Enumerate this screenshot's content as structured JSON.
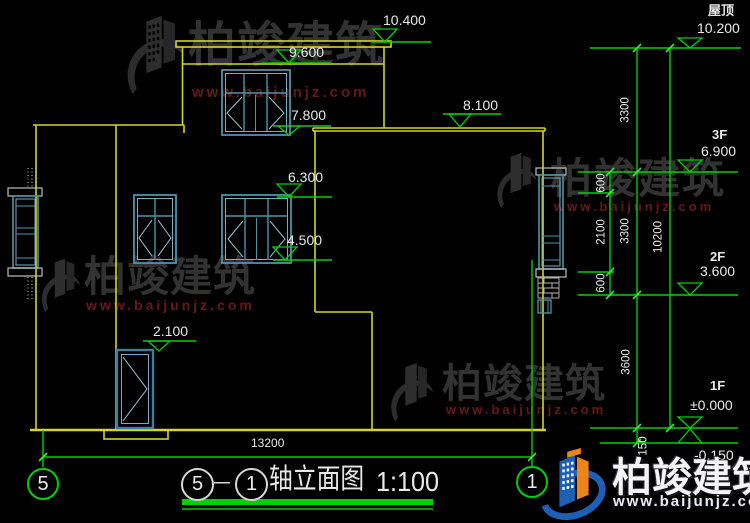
{
  "drawing": {
    "title": {
      "axis_start": "5",
      "separator": "－",
      "axis_end": "1",
      "name": "轴立面图",
      "scale": "1:100"
    },
    "axes": {
      "left": "5",
      "right": "1"
    },
    "levels_left": {
      "v10400": "10.400",
      "v9600": "9.600",
      "v7800": "7.800",
      "v8100": "8.100",
      "v6300": "6.300",
      "v4500": "4.500",
      "v2100": "2.100"
    },
    "levels_right": {
      "roof_label": "屋顶",
      "roof": "10.200",
      "f3_label": "3F",
      "f3": "6.900",
      "f2_label": "2F",
      "f2": "3.600",
      "f1_label": "1F",
      "f1": "±0.000",
      "ground": "-0.150"
    },
    "dims": {
      "d600_top": "600",
      "d2100": "2100",
      "d600_bottom": "600",
      "d3300_top": "3300",
      "d3300_mid": "3300",
      "d3600": "3600",
      "d150": "150",
      "d10200": "10200",
      "d13200": "13200"
    }
  },
  "watermark": {
    "brand": "柏竣建筑",
    "url": "www.baijunjz.com"
  },
  "footer": {
    "brand": "柏竣建筑",
    "url": "www.baijunjz.com"
  }
}
